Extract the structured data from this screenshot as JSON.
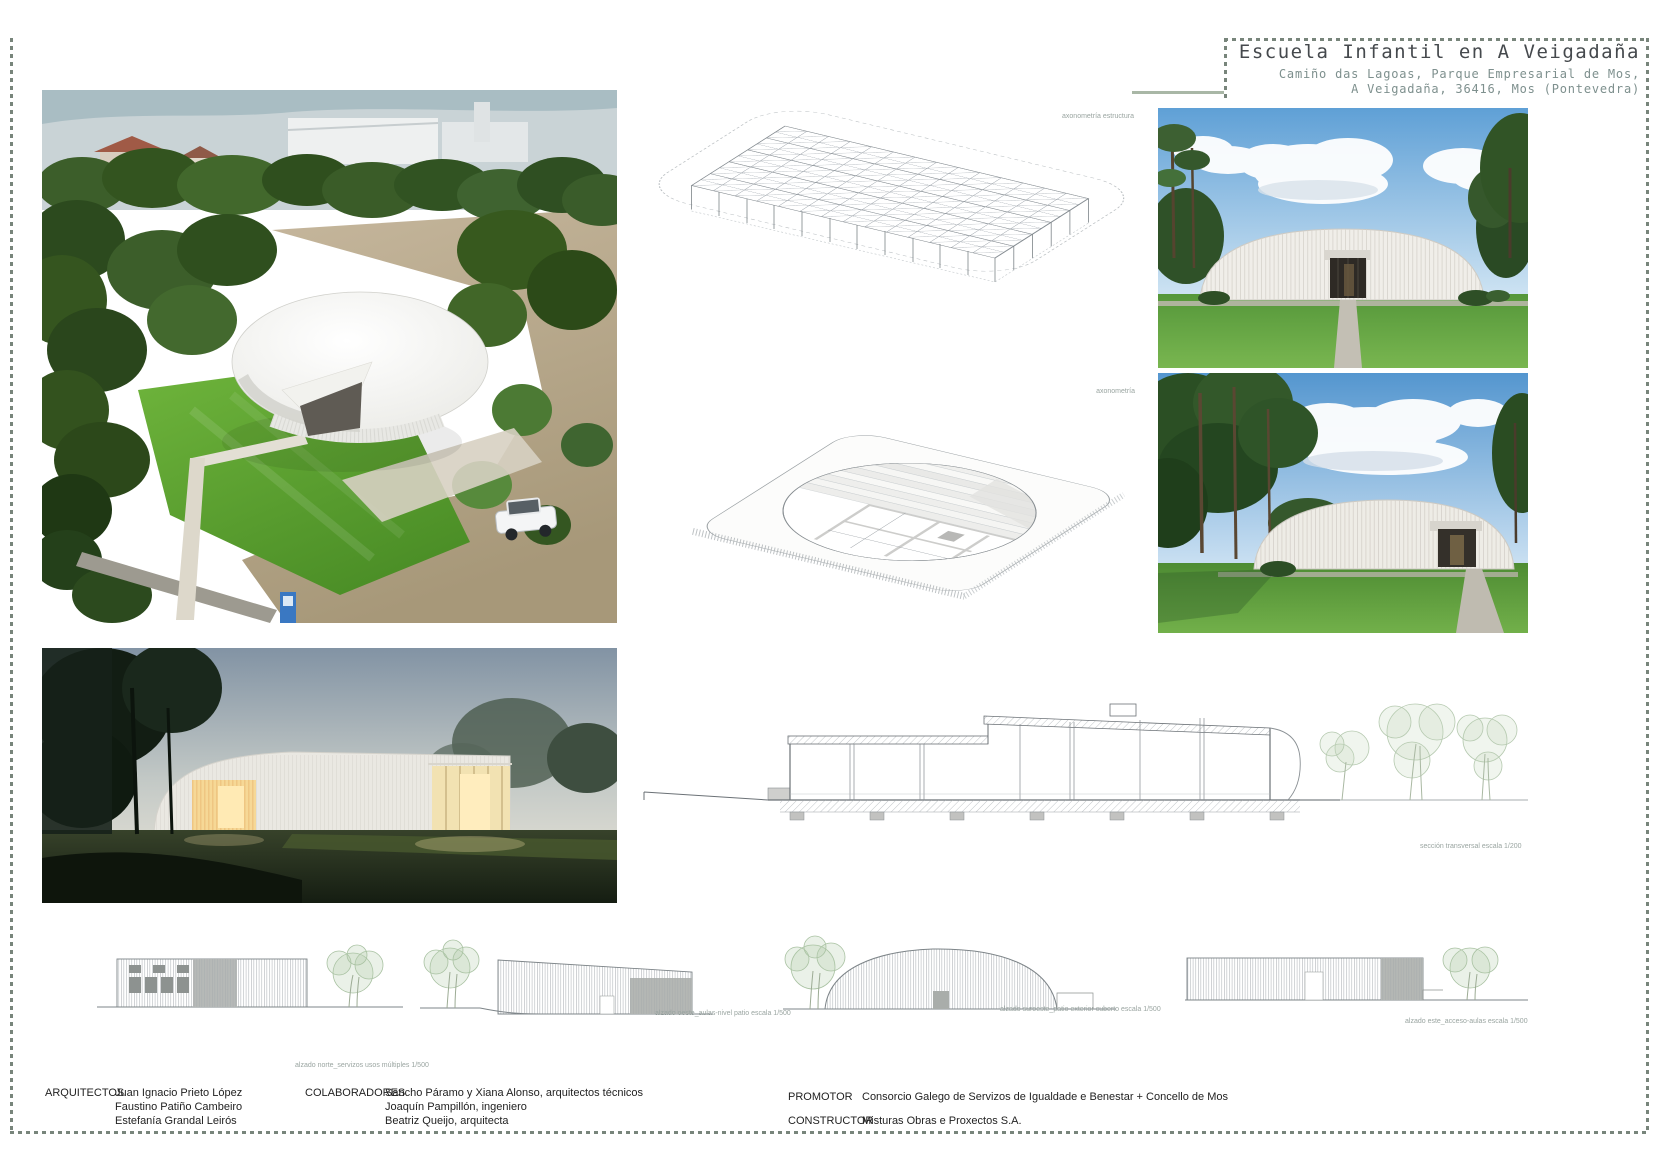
{
  "title_block": {
    "title": "Escuela Infantil en A Veigadaña",
    "address_line1": "Camiño das Lagoas, Parque Empresarial de Mos,",
    "address_line2": "A Veigadaña, 36416, Mos (Pontevedra)"
  },
  "labels": {
    "axon_structure": "axonometría estructura",
    "axon_roof": "axonometría",
    "section_caption": "sección transversal escala 1/200",
    "elevation_caption_1": "alzado norte_servizos usos múltiples 1/500",
    "elevation_caption_2": "alzado oeste_aulas-nivel patio escala 1/500",
    "elevation_caption_3": "alzado suroeste_patio exterior cuberto escala 1/500",
    "elevation_caption_4": "alzado este_acceso-aulas escala 1/500"
  },
  "credits": {
    "architects_label": "ARQUITECTOS",
    "architects": [
      "Juan Ignacio Prieto López",
      "Faustino Patiño Cambeiro",
      "Estefanía Grandal Leirós"
    ],
    "collaborators_label": "COLABORADORES",
    "collaborators": [
      "Sancho Páramo y Xiana Alonso, arquitectos técnicos",
      "Joaquín Pampillón, ingeniero",
      "Beatriz Queijo, arquitecta"
    ],
    "promoter_label": "PROMOTOR",
    "promoter_value": "Consorcio Galego de Servizos de Igualdade e Benestar + Concello de Mos",
    "constructor_label": "CONSTRUCTOR",
    "constructor_value": "Misturas Obras e Proxectos S.A."
  }
}
